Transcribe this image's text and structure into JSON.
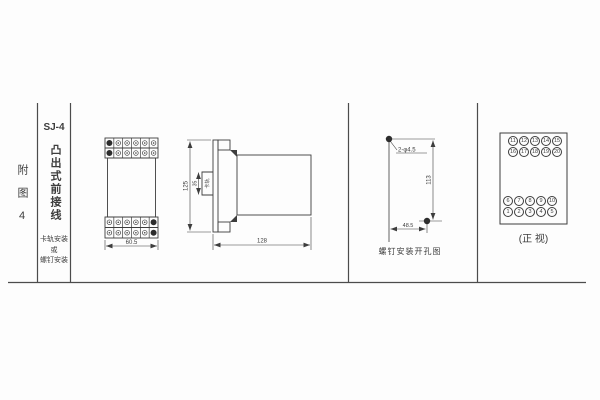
{
  "sidebar": {
    "figure_no": "附图4",
    "model": "SJ-4",
    "description": "凸出式前接线",
    "mount_lines": [
      "卡轨安装",
      "或",
      "螺钉安装"
    ]
  },
  "front_view": {
    "width_dim": "60.5",
    "grid": {
      "rows": 2,
      "cols": 6
    }
  },
  "side_view": {
    "height_dim": "125",
    "depth_dim": "128",
    "rail_dim": "35",
    "rail_label": "卡轨"
  },
  "drill_view": {
    "hole_label": "2-φ4.5",
    "vertical_dim": "113",
    "horizontal_dim": "48.5",
    "caption": "螺钉安装开孔图"
  },
  "rear_view": {
    "caption": "(正 视)",
    "top_rows": [
      [
        11,
        12,
        13,
        14,
        15
      ],
      [
        16,
        17,
        18,
        19,
        20
      ]
    ],
    "bottom_rows": [
      [
        6,
        7,
        8,
        9,
        10
      ],
      [
        1,
        2,
        3,
        4,
        5
      ]
    ]
  }
}
